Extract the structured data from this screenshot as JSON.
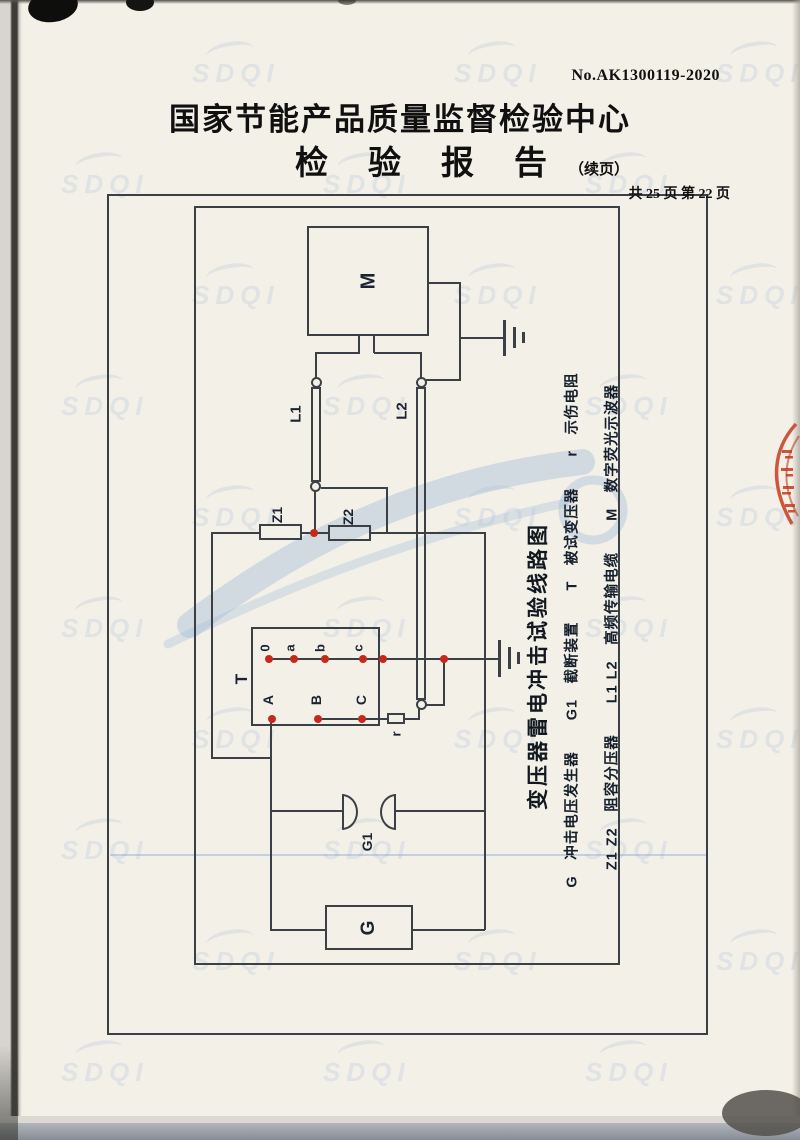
{
  "header": {
    "doc_no": "No.AK1300119-2020",
    "org_title": "国家节能产品质量监督检验中心",
    "report_title": "检验报告",
    "report_title_suffix": "（续页）",
    "page_info": "共 25 页 第 22 页"
  },
  "diagram": {
    "caption": "变压器雷电冲击试验线路图",
    "legend_line1": "G　冲击电压发生器　　G1　截断装置　　T　被试变压器　　r　示伤电阻",
    "legend_line2": "Z1 Z2　阻容分压器　　L1 L2　高频传输电缆　　M　数字荧光示波器",
    "labels": {
      "oscilloscope": "M",
      "cable1": "L1",
      "cable2": "L2",
      "divider1": "Z1",
      "divider2": "Z2",
      "transformer": "T",
      "chopping_gap": "G1",
      "generator": "G",
      "resistor": "r",
      "terminals_top": [
        "0",
        "a",
        "b",
        "c"
      ],
      "terminals_bottom": [
        "A",
        "B",
        "C"
      ]
    },
    "colors": {
      "line": "#3a4046",
      "terminal_dot": "#c5291b",
      "watermark": "#86a5cb",
      "stamp": "#c63b20"
    }
  },
  "watermark": {
    "text": "SDQI"
  }
}
